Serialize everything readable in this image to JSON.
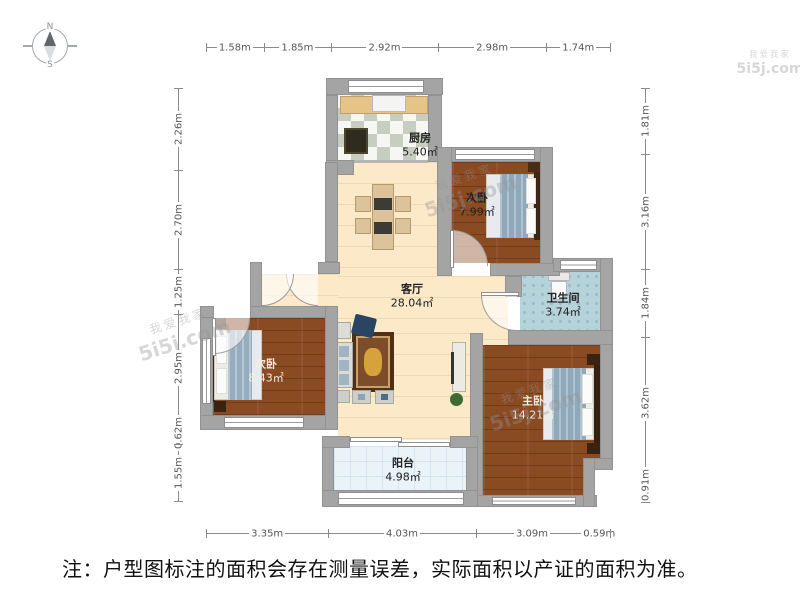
{
  "note": {
    "text": "注：户型图标注的面积会存在测量误差，实际面积以产证的面积为准。"
  },
  "compass": {
    "north": "N",
    "south": "S"
  },
  "watermark": {
    "cn": "我爱我家",
    "url": "5i5j.com"
  },
  "rooms": [
    {
      "name": "厨房",
      "area": "5.40㎡"
    },
    {
      "name": "次卧",
      "area": "7.99㎡"
    },
    {
      "name": "卫生间",
      "area": "3.74㎡"
    },
    {
      "name": "客厅",
      "area": "28.04㎡"
    },
    {
      "name": "次卧",
      "area": "8.43㎡"
    },
    {
      "name": "主卧",
      "area": "14.21㎡"
    },
    {
      "name": "阳台",
      "area": "4.98㎡"
    }
  ],
  "rulers": {
    "top": [
      "1.58m",
      "1.85m",
      "2.92m",
      "2.98m",
      "1.74m"
    ],
    "bottom": [
      "3.35m",
      "4.03m",
      "3.09m",
      "0.59m"
    ],
    "left": [
      "2.26m",
      "2.70m",
      "1.25m",
      "2.95m",
      "0.62m",
      "1.55m"
    ],
    "right": [
      "1.81m",
      "3.16m",
      "1.84m",
      "3.62m",
      "0.91m"
    ]
  },
  "colors": {
    "wall": "#a4a4a4",
    "wood_floor": "#8a4a22",
    "living_floor": "#fce9c8",
    "bath_floor": "#b7d3da",
    "balcony_floor": "#e9f3f8",
    "kitchen_tile": "#c7cdbf",
    "blanket": "#8fa8ba",
    "rug": "#7d4c28"
  }
}
